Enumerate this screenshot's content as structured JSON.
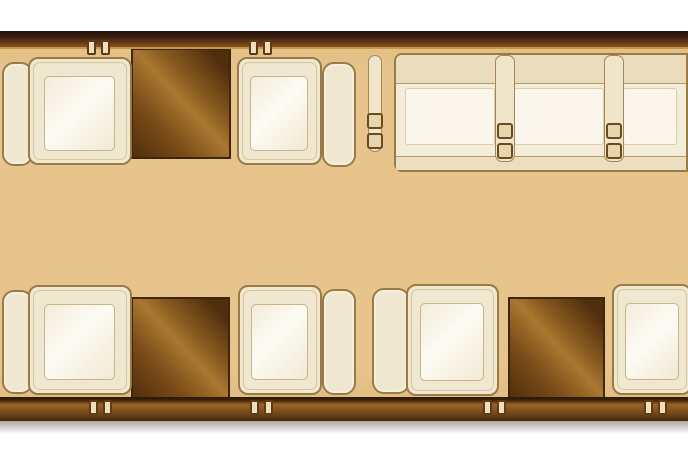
{
  "description": "Private jet cabin floor plan section: four single club seats facing two wood tables (upper-left and lower-left groups), a three-place divan sofa with seat-belt dividers along the upper-right wall, and a facing club-seat pair with a third wood table at lower-right. Dark wood fuselage walls run along top and bottom with paired anchor knobs.",
  "colors": {
    "floor": "#e7c48c",
    "wallTopDark": "#1f1008",
    "wallTopMid": "#6e3f18",
    "wallGold": "#c6974a",
    "wallBotLight": "#9a6526",
    "wallBotDark": "#46280e",
    "seatFill": "#f0e7d0",
    "seatBorder": "#9b7b45",
    "cushionFill": "#f7f2e4",
    "cushionBorder": "#c9b587",
    "cushionHi": "#fdfbf4",
    "woodLight": "#aa7830",
    "woodMid": "#7a4c18",
    "woodDark": "#4f2e0c",
    "woodOutline": "#40250d",
    "divanBack": "#eaddbe",
    "divanFill": "#f3ecd9",
    "divanHi": "#faf6ec",
    "divanLine": "#b49a66",
    "anchorFill": "#eee0ba",
    "anchorBorder": "#5f3c16"
  },
  "floorplan": {
    "canvas": {
      "width": 688,
      "height": 458
    },
    "seats": [
      {
        "id": "1",
        "row": "top",
        "facing": "right",
        "body": {
          "x": 28,
          "y": 57,
          "w": 104,
          "h": 108
        },
        "back": {
          "x": 2,
          "y": 62,
          "w": 31,
          "h": 104
        }
      },
      {
        "id": "2",
        "row": "top",
        "facing": "left",
        "body": {
          "x": 237,
          "y": 57,
          "w": 85,
          "h": 108
        },
        "back": {
          "x": 322,
          "y": 62,
          "w": 34,
          "h": 105
        }
      },
      {
        "id": "3",
        "row": "bottom",
        "facing": "right",
        "body": {
          "x": 28,
          "y": 285,
          "w": 104,
          "h": 110
        },
        "back": {
          "x": 2,
          "y": 290,
          "w": 31,
          "h": 104
        }
      },
      {
        "id": "4",
        "row": "bottom",
        "facing": "left",
        "body": {
          "x": 238,
          "y": 285,
          "w": 84,
          "h": 110
        },
        "back": {
          "x": 322,
          "y": 289,
          "w": 34,
          "h": 106
        }
      },
      {
        "id": "5",
        "row": "bottom",
        "facing": "right",
        "body": {
          "x": 406,
          "y": 284,
          "w": 93,
          "h": 112
        },
        "back": {
          "x": 372,
          "y": 288,
          "w": 38,
          "h": 106
        }
      },
      {
        "id": "6",
        "row": "bottom",
        "facing": "left",
        "body": {
          "x": 612,
          "y": 284,
          "w": 80,
          "h": 111
        },
        "back": null
      }
    ],
    "tables": [
      {
        "id": "1",
        "x": 131,
        "y": 48,
        "w": 100,
        "h": 111
      },
      {
        "id": "2",
        "x": 131,
        "y": 297,
        "w": 99,
        "h": 103
      },
      {
        "id": "3",
        "x": 508,
        "y": 297,
        "w": 97,
        "h": 103
      }
    ],
    "divan": {
      "rect": {
        "x": 394,
        "y": 53,
        "w": 294,
        "h": 119
      },
      "places": 3,
      "section_widths": [
        109,
        109,
        76
      ]
    },
    "seatbelts": [
      {
        "x": 368,
        "y": 55,
        "w": 14,
        "h": 97
      },
      {
        "x": 495,
        "y": 55,
        "w": 20,
        "h": 107
      },
      {
        "x": 604,
        "y": 55,
        "w": 20,
        "h": 107
      }
    ],
    "anchors": [
      {
        "wall": "top",
        "x": 87,
        "y": 40
      },
      {
        "wall": "top",
        "x": 249,
        "y": 40
      },
      {
        "wall": "bottom",
        "x": 89,
        "y": 400
      },
      {
        "wall": "bottom",
        "x": 250,
        "y": 400
      },
      {
        "wall": "bottom",
        "x": 483,
        "y": 400
      },
      {
        "wall": "bottom",
        "x": 644,
        "y": 400
      }
    ]
  }
}
